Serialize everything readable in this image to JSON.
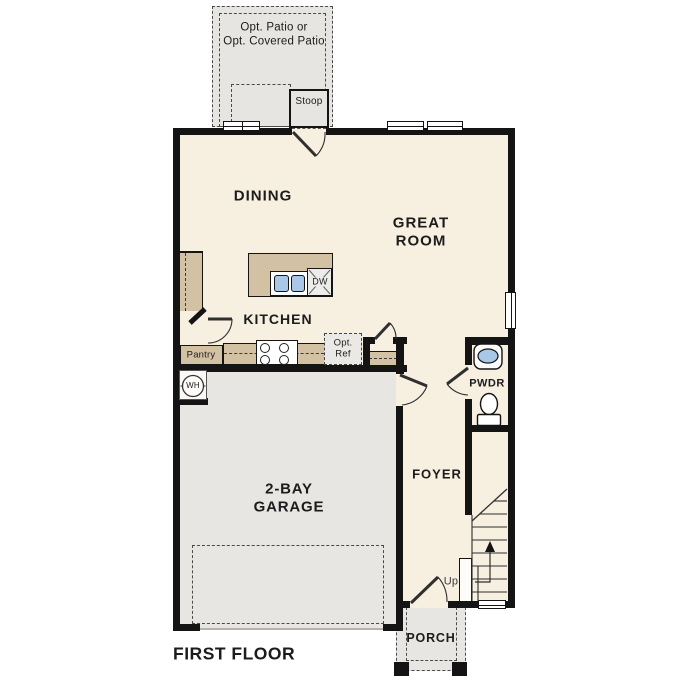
{
  "plan": {
    "floor_title": "FIRST FLOOR"
  },
  "labels": {
    "patio_line1": "Opt. Patio or",
    "patio_line2": "Opt. Covered Patio",
    "stoop": "Stoop",
    "dining": "DINING",
    "great_line1": "GREAT",
    "great_line2": "ROOM",
    "kitchen": "KITCHEN",
    "dw": "DW",
    "pantry": "Pantry",
    "ref_line1": "Opt.",
    "ref_line2": "Ref",
    "wh": "WH",
    "pwdr": "PWDR",
    "foyer": "FOYER",
    "garage_line1": "2-BAY",
    "garage_line2": "GARAGE",
    "up": "Up",
    "porch": "PORCH"
  },
  "colors": {
    "wall": "#141414",
    "interior": "#f7efe0",
    "cabinet_tan": "#d3c1a3",
    "concrete_grey": "#e7e6e3",
    "fixture_blue": "#a9c7e7"
  }
}
